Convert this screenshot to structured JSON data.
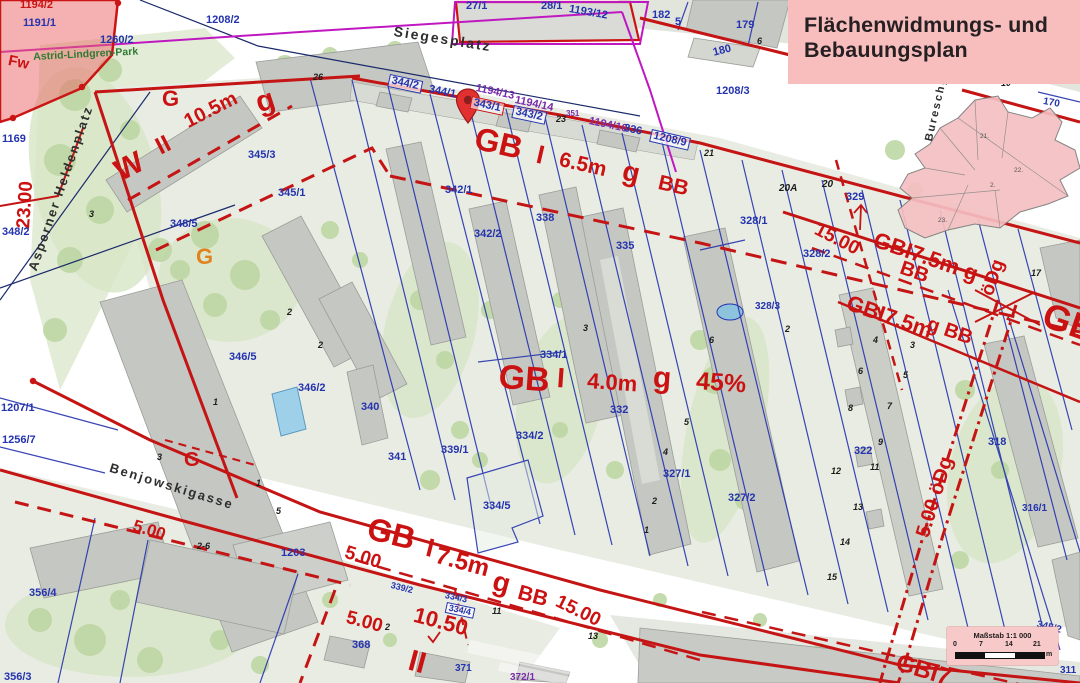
{
  "title_box": {
    "line1": "Flächenwidmungs- und",
    "line2": "Bebauungsplan"
  },
  "scale_bar": {
    "title": "Maßstab 1:1 000",
    "ticks": [
      "0",
      "7",
      "14",
      "21"
    ],
    "unit": "m"
  },
  "colors": {
    "zone_red": "#cb1212",
    "parcel_blue": "#2433ae",
    "purple": "#7a2daa",
    "magenta": "#c018c0",
    "title_bg": "#f8bebe",
    "scale_bg": "#f8c9c9",
    "building_gray": "#c5c7c2",
    "park_green": "#bcd6a2",
    "pin_red": "#e23030",
    "inset_pink": "#f5bfc2",
    "water_blue": "#8ec3de"
  },
  "map": {
    "labels": {
      "streets": [
        {
          "t": "Siegesplatz",
          "x": 395,
          "y": 24,
          "fs": 14,
          "rot": 9
        },
        {
          "t": "Asperner Heldenplatz",
          "x": 26,
          "y": 268,
          "fs": 13,
          "rot": -71
        },
        {
          "t": "Benjowskigasse",
          "x": 112,
          "y": 461,
          "fs": 13,
          "rot": 17
        },
        {
          "t": "Bureschg",
          "x": 924,
          "y": 140,
          "fs": 11,
          "rot": -77
        }
      ],
      "zones": [
        {
          "t": "Fw",
          "x": 10,
          "y": 53,
          "fs": 15,
          "rot": 12
        },
        {
          "t": "G",
          "x": 162,
          "y": 88,
          "fs": 22
        },
        {
          "t": "g",
          "x": 252,
          "y": 90,
          "fs": 30,
          "rot": -18
        },
        {
          "t": "W",
          "x": 110,
          "y": 160,
          "fs": 30,
          "rot": -27
        },
        {
          "t": "II",
          "x": 152,
          "y": 138,
          "fs": 24,
          "rot": -27
        },
        {
          "t": "10.5m",
          "x": 181,
          "y": 114,
          "fs": 20,
          "rot": -27
        },
        {
          "t": "23.00",
          "x": 14,
          "y": 228,
          "fs": 19,
          "rot": -86
        },
        {
          "t": "G",
          "x": 196,
          "y": 246,
          "fs": 22,
          "c": "#e0831f"
        },
        {
          "t": "G",
          "x": 184,
          "y": 450,
          "fs": 20
        },
        {
          "t": "GB",
          "x": 479,
          "y": 122,
          "fs": 32,
          "rot": 13
        },
        {
          "t": "I",
          "x": 540,
          "y": 141,
          "fs": 26,
          "rot": 13
        },
        {
          "t": "6.5m",
          "x": 562,
          "y": 149,
          "fs": 21,
          "rot": 13
        },
        {
          "t": "g",
          "x": 626,
          "y": 157,
          "fs": 28,
          "rot": 13
        },
        {
          "t": "BB",
          "x": 661,
          "y": 172,
          "fs": 21,
          "rot": 13
        },
        {
          "t": "GB",
          "x": 500,
          "y": 360,
          "fs": 34,
          "rot": 4
        },
        {
          "t": "I",
          "x": 558,
          "y": 364,
          "fs": 28,
          "rot": 4
        },
        {
          "t": "4.0m",
          "x": 588,
          "y": 370,
          "fs": 22,
          "rot": 4
        },
        {
          "t": "g",
          "x": 654,
          "y": 363,
          "fs": 30,
          "rot": 4
        },
        {
          "t": "45%",
          "x": 697,
          "y": 369,
          "fs": 25,
          "rot": 4
        },
        {
          "t": "15.00",
          "x": 820,
          "y": 220,
          "fs": 19,
          "rot": 27
        },
        {
          "t": "GBI7.5m g",
          "x": 878,
          "y": 229,
          "fs": 22,
          "rot": 19
        },
        {
          "t": "BB",
          "x": 904,
          "y": 258,
          "fs": 20,
          "rot": 19
        },
        {
          "t": "öDg",
          "x": 978,
          "y": 292,
          "fs": 19,
          "rot": -71
        },
        {
          "t": "GBI7.5m",
          "x": 851,
          "y": 292,
          "fs": 22,
          "rot": 19
        },
        {
          "t": "g BB",
          "x": 931,
          "y": 314,
          "fs": 20,
          "rot": 19
        },
        {
          "t": "GB",
          "x": 1050,
          "y": 297,
          "fs": 36,
          "rot": 19
        },
        {
          "t": "5.00 öDg",
          "x": 913,
          "y": 534,
          "fs": 20,
          "rot": -73
        },
        {
          "t": "GB",
          "x": 372,
          "y": 512,
          "fs": 32,
          "rot": 14
        },
        {
          "t": "I",
          "x": 430,
          "y": 534,
          "fs": 26,
          "rot": 14
        },
        {
          "t": "7.5m",
          "x": 439,
          "y": 544,
          "fs": 24,
          "rot": 15
        },
        {
          "t": "g",
          "x": 497,
          "y": 567,
          "fs": 28,
          "rot": 15
        },
        {
          "t": "BB",
          "x": 521,
          "y": 582,
          "fs": 21,
          "rot": 15
        },
        {
          "t": "15.00",
          "x": 561,
          "y": 592,
          "fs": 19,
          "rot": 26
        },
        {
          "t": "5.00",
          "x": 136,
          "y": 517,
          "fs": 17,
          "rot": 17
        },
        {
          "t": "5.00",
          "x": 348,
          "y": 543,
          "fs": 19,
          "rot": 17
        },
        {
          "t": "5.00",
          "x": 349,
          "y": 608,
          "fs": 19,
          "rot": 15
        },
        {
          "t": "10.50",
          "x": 417,
          "y": 604,
          "fs": 22,
          "rot": 15
        },
        {
          "t": "II",
          "x": 413,
          "y": 646,
          "fs": 30,
          "rot": 15
        },
        {
          "t": "GBI7",
          "x": 900,
          "y": 651,
          "fs": 24,
          "rot": 17
        }
      ],
      "parcels": [
        {
          "t": "1194/2",
          "x": 20,
          "y": 0,
          "cls": "redp"
        },
        {
          "t": "1191/1",
          "x": 23,
          "y": 18
        },
        {
          "t": "1260/2",
          "x": 100,
          "y": 35
        },
        {
          "t": "1208/2",
          "x": 206,
          "y": 15
        },
        {
          "t": "27/1",
          "x": 466,
          "y": 1
        },
        {
          "t": "28/1",
          "x": 541,
          "y": 1
        },
        {
          "t": "1193/12",
          "x": 570,
          "y": 4,
          "rot": 10
        },
        {
          "t": "182",
          "x": 652,
          "y": 10
        },
        {
          "t": "5",
          "x": 675,
          "y": 17,
          "cls": "addr-like"
        },
        {
          "t": "179",
          "x": 736,
          "y": 20
        },
        {
          "t": "180",
          "x": 712,
          "y": 48,
          "rot": -14
        },
        {
          "t": "1208/3",
          "x": 716,
          "y": 86
        },
        {
          "t": "170",
          "x": 1044,
          "y": 97,
          "fs": 10,
          "rot": 10
        },
        {
          "t": "1169",
          "x": 2,
          "y": 134
        },
        {
          "t": "348/2",
          "x": 2,
          "y": 227
        },
        {
          "t": "348/5",
          "x": 170,
          "y": 219
        },
        {
          "t": "345/3",
          "x": 248,
          "y": 150
        },
        {
          "t": "345/1",
          "x": 278,
          "y": 188
        },
        {
          "t": "342/1",
          "x": 445,
          "y": 185
        },
        {
          "t": "342/2",
          "x": 474,
          "y": 229
        },
        {
          "t": "338",
          "x": 536,
          "y": 213
        },
        {
          "t": "335",
          "x": 616,
          "y": 241
        },
        {
          "t": "344/2",
          "x": 390,
          "y": 74,
          "rot": 12,
          "cls": "boxed"
        },
        {
          "t": "344/1",
          "x": 430,
          "y": 84,
          "rot": 12
        },
        {
          "t": "1194/13",
          "x": 477,
          "y": 83,
          "rot": 12,
          "cls": "purple"
        },
        {
          "t": "343/1",
          "x": 472,
          "y": 96,
          "rot": 12,
          "cls": "boxedred"
        },
        {
          "t": "1194/14",
          "x": 516,
          "y": 95,
          "rot": 12,
          "cls": "purple"
        },
        {
          "t": "343/2",
          "x": 514,
          "y": 105,
          "rot": 12,
          "cls": "boxed"
        },
        {
          "t": "351",
          "x": 566,
          "y": 110,
          "fs": 8,
          "cls": "purple"
        },
        {
          "t": "1194/10",
          "x": 590,
          "y": 116,
          "rot": 12,
          "cls": "purple"
        },
        {
          "t": "336",
          "x": 625,
          "y": 123,
          "rot": 12
        },
        {
          "t": "1208/9",
          "x": 652,
          "y": 129,
          "rot": 13,
          "cls": "boxed"
        },
        {
          "t": "328/1",
          "x": 740,
          "y": 216
        },
        {
          "t": "329",
          "x": 846,
          "y": 192
        },
        {
          "t": "328/2",
          "x": 803,
          "y": 249
        },
        {
          "t": "328/3",
          "x": 755,
          "y": 302,
          "fs": 10
        },
        {
          "t": "334/1",
          "x": 540,
          "y": 350
        },
        {
          "t": "332",
          "x": 610,
          "y": 405
        },
        {
          "t": "334/2",
          "x": 516,
          "y": 431
        },
        {
          "t": "327/1",
          "x": 663,
          "y": 469
        },
        {
          "t": "327/2",
          "x": 728,
          "y": 493
        },
        {
          "t": "322",
          "x": 854,
          "y": 446
        },
        {
          "t": "318",
          "x": 988,
          "y": 437
        },
        {
          "t": "316/1",
          "x": 1022,
          "y": 504,
          "fs": 10
        },
        {
          "t": "346/5",
          "x": 229,
          "y": 352
        },
        {
          "t": "346/2",
          "x": 298,
          "y": 383
        },
        {
          "t": "340",
          "x": 361,
          "y": 402
        },
        {
          "t": "341",
          "x": 388,
          "y": 452
        },
        {
          "t": "339/1",
          "x": 441,
          "y": 445
        },
        {
          "t": "334/5",
          "x": 483,
          "y": 501
        },
        {
          "t": "339/2",
          "x": 392,
          "y": 581,
          "fs": 9,
          "rot": 14
        },
        {
          "t": "334/3",
          "x": 446,
          "y": 591,
          "fs": 9,
          "rot": 12
        },
        {
          "t": "334/4",
          "x": 447,
          "y": 602,
          "fs": 9,
          "rot": 12,
          "cls": "boxed"
        },
        {
          "t": "368",
          "x": 352,
          "y": 640
        },
        {
          "t": "371",
          "x": 455,
          "y": 664,
          "fs": 10
        },
        {
          "t": "372/1",
          "x": 510,
          "y": 673,
          "fs": 10,
          "cls": "purple"
        },
        {
          "t": "356/4",
          "x": 29,
          "y": 588
        },
        {
          "t": "356/3",
          "x": 4,
          "y": 672
        },
        {
          "t": "1207/1",
          "x": 1,
          "y": 403
        },
        {
          "t": "1256/7",
          "x": 2,
          "y": 435
        },
        {
          "t": "1203",
          "x": 281,
          "y": 548
        },
        {
          "t": "345/2",
          "x": 1038,
          "y": 620,
          "fs": 10,
          "rot": 14
        },
        {
          "t": "311",
          "x": 1060,
          "y": 666,
          "fs": 10
        }
      ],
      "addresses": [
        {
          "t": "26",
          "x": 313,
          "y": 73
        },
        {
          "t": "23",
          "x": 556,
          "y": 115
        },
        {
          "t": "21",
          "x": 704,
          "y": 149
        },
        {
          "t": "20A",
          "x": 779,
          "y": 184,
          "fs": 10
        },
        {
          "t": "20",
          "x": 822,
          "y": 180,
          "fs": 10
        },
        {
          "t": "17",
          "x": 1031,
          "y": 269
        },
        {
          "t": "10",
          "x": 1001,
          "y": 79
        },
        {
          "t": "6",
          "x": 757,
          "y": 37
        },
        {
          "t": "3",
          "x": 89,
          "y": 210
        },
        {
          "t": "3",
          "x": 157,
          "y": 453
        },
        {
          "t": "1",
          "x": 213,
          "y": 398
        },
        {
          "t": "2",
          "x": 287,
          "y": 308
        },
        {
          "t": "2",
          "x": 318,
          "y": 341
        },
        {
          "t": "1",
          "x": 256,
          "y": 479
        },
        {
          "t": "5",
          "x": 276,
          "y": 507
        },
        {
          "t": "2-6",
          "x": 197,
          "y": 542
        },
        {
          "t": "3",
          "x": 583,
          "y": 324
        },
        {
          "t": "4",
          "x": 663,
          "y": 448
        },
        {
          "t": "5",
          "x": 684,
          "y": 418
        },
        {
          "t": "6",
          "x": 709,
          "y": 336
        },
        {
          "t": "2",
          "x": 785,
          "y": 325
        },
        {
          "t": "4",
          "x": 873,
          "y": 336
        },
        {
          "t": "3",
          "x": 910,
          "y": 341
        },
        {
          "t": "6",
          "x": 858,
          "y": 367
        },
        {
          "t": "5",
          "x": 903,
          "y": 371
        },
        {
          "t": "8",
          "x": 848,
          "y": 404
        },
        {
          "t": "7",
          "x": 887,
          "y": 402
        },
        {
          "t": "9",
          "x": 878,
          "y": 438
        },
        {
          "t": "11",
          "x": 870,
          "y": 463
        },
        {
          "t": "12",
          "x": 831,
          "y": 467
        },
        {
          "t": "13",
          "x": 853,
          "y": 503
        },
        {
          "t": "14",
          "x": 840,
          "y": 538
        },
        {
          "t": "15",
          "x": 827,
          "y": 573
        },
        {
          "t": "11",
          "x": 492,
          "y": 607
        },
        {
          "t": "13",
          "x": 588,
          "y": 632
        },
        {
          "t": "2",
          "x": 385,
          "y": 623
        },
        {
          "t": "2",
          "x": 652,
          "y": 497
        },
        {
          "t": "1",
          "x": 644,
          "y": 526
        }
      ],
      "park": [
        {
          "t": "Astrid-Lindgren-Park",
          "x": 33,
          "y": 52,
          "rot": -3
        }
      ],
      "inset": [
        {
          "t": "21.",
          "x": 980,
          "y": 134
        },
        {
          "t": "22.",
          "x": 1014,
          "y": 168
        },
        {
          "t": "2.",
          "x": 990,
          "y": 183
        },
        {
          "t": "23.",
          "x": 938,
          "y": 218
        }
      ]
    }
  }
}
